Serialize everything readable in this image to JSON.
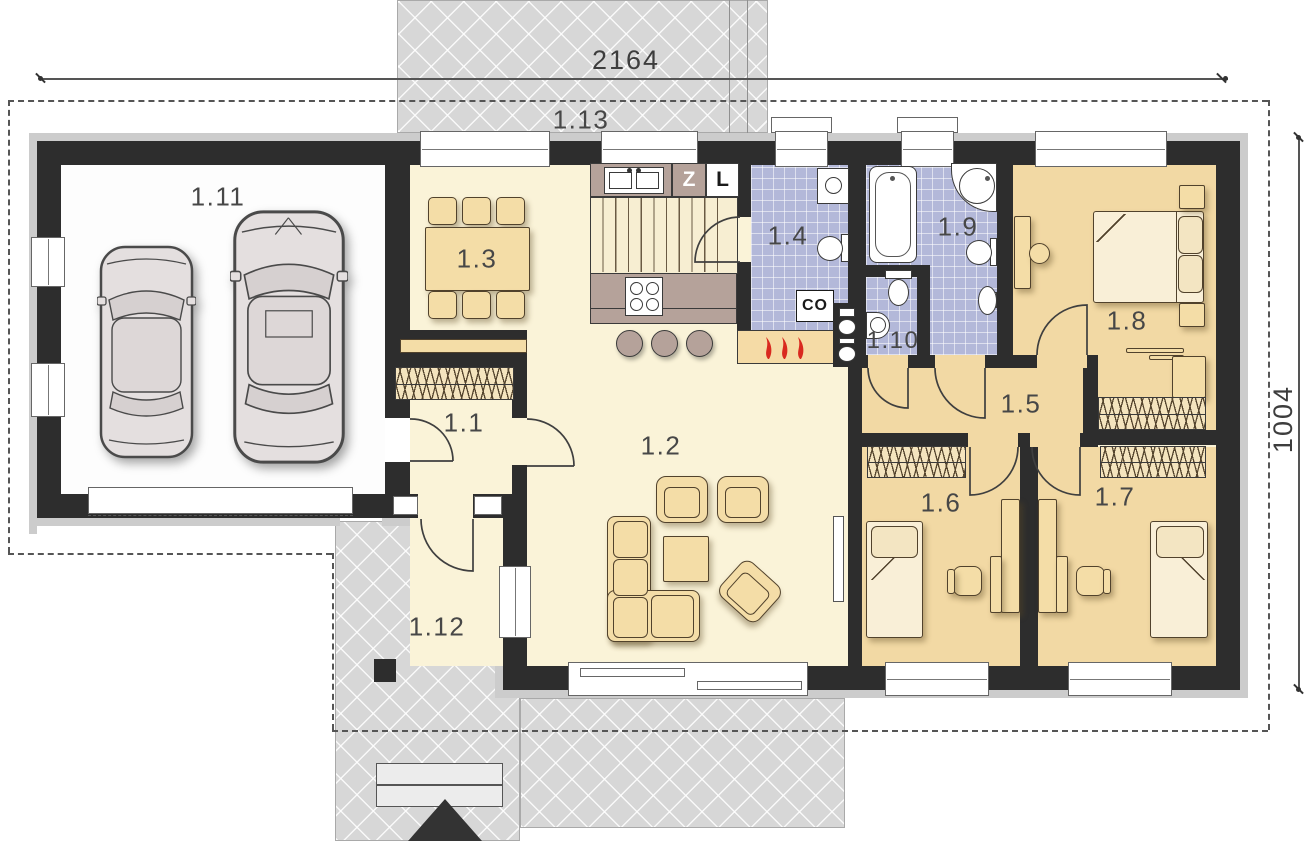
{
  "dimensions": {
    "top": "2164",
    "right": "1004"
  },
  "rooms": {
    "hall": {
      "label": "1.1"
    },
    "living_room": {
      "label": "1.2"
    },
    "dining": {
      "label": "1.3"
    },
    "bathroom": {
      "label": "1.4"
    },
    "corridor": {
      "label": "1.5"
    },
    "bedroom_1": {
      "label": "1.6"
    },
    "bedroom_2": {
      "label": "1.7"
    },
    "bedroom_3": {
      "label": "1.8"
    },
    "bathroom_2": {
      "label": "1.9"
    },
    "wc": {
      "label": "1.10"
    },
    "garage": {
      "label": "1.11"
    },
    "terrace_entry": {
      "label": "1.12"
    },
    "terrace_garden": {
      "label": "1.13"
    }
  },
  "kitchen": {
    "sink_cabinet_label": "Z",
    "fridge_label": "L"
  },
  "heating": {
    "boiler_label": "CO"
  },
  "colors": {
    "wall": "#2d2d2d",
    "floor": "#faf3d8",
    "bedroom_floor": "#f2d9a4",
    "bath_tile": "#b3b8d9",
    "terrace": "#d7d7d7",
    "kitchen_counter": "#b5a29a",
    "flame": "#d9291f",
    "furniture": "#f4dda7"
  }
}
